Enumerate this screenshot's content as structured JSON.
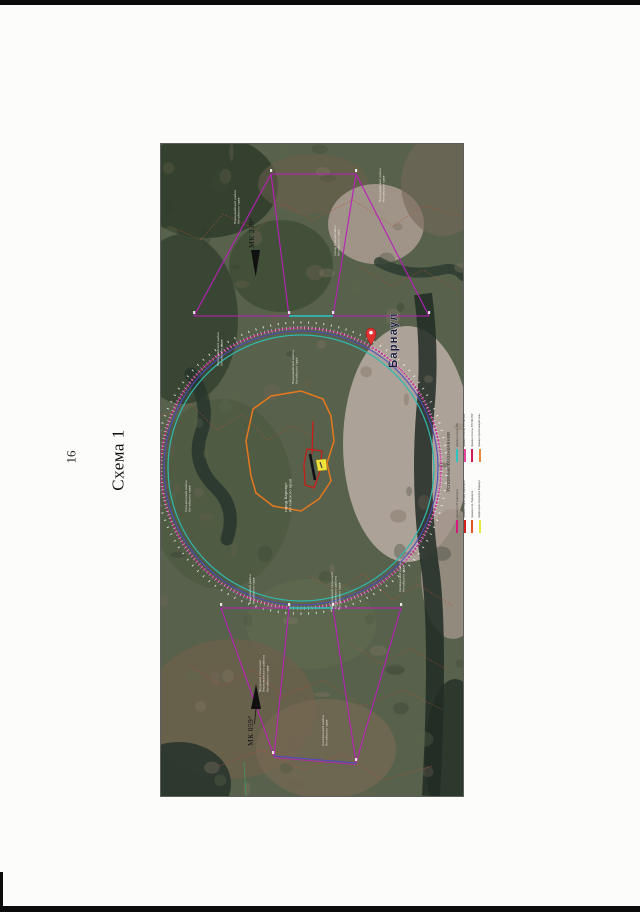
{
  "page": {
    "number": "16",
    "caption": "Схема 1"
  },
  "map": {
    "city": "Барнаул",
    "course_labels": {
      "top": "МК 239°",
      "bottom": "МК 059°"
    },
    "area_labels": [
      {
        "x": 75,
        "y": 80,
        "lines": [
          "Первомайский район",
          "Алтайского края"
        ]
      },
      {
        "x": 220,
        "y": 58,
        "lines": [
          "Первомайский район",
          "Алтайского края"
        ]
      },
      {
        "x": 175,
        "y": 112,
        "lines": [
          "город Новоалтайск",
          "Алтайского края"
        ]
      },
      {
        "x": 58,
        "y": 222,
        "lines": [
          "Первомайский район",
          "Алтайского края"
        ]
      },
      {
        "x": 133,
        "y": 240,
        "lines": [
          "Первомайский район",
          "Алтайского края"
        ]
      },
      {
        "x": 126,
        "y": 368,
        "fs": 4,
        "lines": [
          "город Барнаул",
          "Алтайского края"
        ]
      },
      {
        "x": 26,
        "y": 368,
        "lines": [
          "Тальменский район",
          "Алтайского края"
        ]
      },
      {
        "x": 90,
        "y": 460,
        "lines": [
          "Павловский район",
          "Алтайского края"
        ]
      },
      {
        "x": 172,
        "y": 465,
        "lines": [
          "Шадринский сельсовет",
          "Калманского района",
          "Алтайского края"
        ]
      },
      {
        "x": 240,
        "y": 448,
        "lines": [
          "Калманский район",
          "Алтайского края"
        ]
      },
      {
        "x": 100,
        "y": 548,
        "lines": [
          "Прудской сельсовет",
          "Первомайского района",
          "Алтайского края"
        ]
      },
      {
        "x": 163,
        "y": 602,
        "lines": [
          "Косихинский район",
          "Алтайского края"
        ]
      }
    ],
    "legend": {
      "title": "Условные обозначения",
      "columns": [
        {
          "items": [
            {
              "color": "#d81a7e",
              "label": "граница СЗЗ аэропорта"
            },
            {
              "color": "#d42020",
              "label": "граница территории аэропорта"
            },
            {
              "color": "#e05522",
              "label": "граница гор. Барнаула"
            },
            {
              "color": "#e8e83a",
              "label": "территория аэропорта Барнаул"
            }
          ]
        },
        {
          "items": [
            {
              "color": "#2fc4c4",
              "label": "граница полосы ВП"
            },
            {
              "color": "#e8489b",
              "label": "граница полосы ВП МК 239°"
            },
            {
              "color": "#d41a55",
              "label": "граница полосы ВП МК 059°"
            },
            {
              "color": "#e8883a",
              "label": "граница прилегающей зоны"
            }
          ]
        }
      ]
    },
    "ring_colors": {
      "outer": "#d4189b",
      "mid": "#4f46c8",
      "inner": "#2fb9ae"
    },
    "sector_color": "#b81fb8",
    "feature_colors": {
      "city_boundary": "#e6791e",
      "airport_outline": "#cc1b15",
      "marker": "#f0e23a"
    }
  }
}
